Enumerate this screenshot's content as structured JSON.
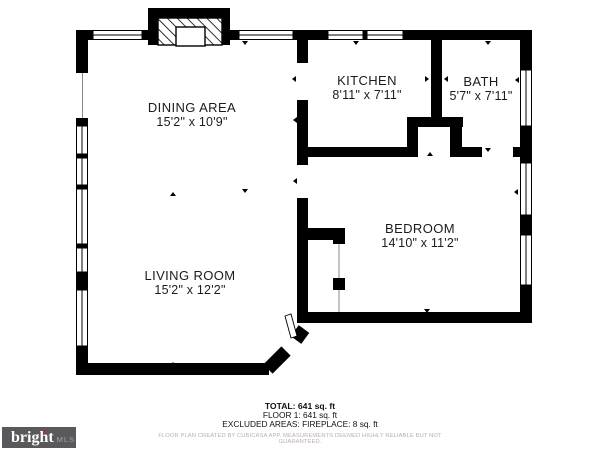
{
  "title": "Floor plan",
  "rooms": [
    {
      "id": "dining",
      "name": "DINING AREA",
      "dims": "15'2\" x 10'9\""
    },
    {
      "id": "kitchen",
      "name": "KITCHEN",
      "dims": "8'11\" x 7'11\""
    },
    {
      "id": "bath",
      "name": "BATH",
      "dims": "5'7\" x 7'11\""
    },
    {
      "id": "living",
      "name": "LIVING ROOM",
      "dims": "15'2\" x 12'2\""
    },
    {
      "id": "bedroom",
      "name": "BEDROOM",
      "dims": "14'10\" x 11'2\""
    }
  ],
  "summary": {
    "total": "TOTAL: 641 sq. ft",
    "floor1": "FLOOR 1: 641 sq. ft",
    "excluded": "EXCLUDED AREAS: FIREPLACE: 8 sq. ft",
    "disclaimer": "FLOOR PLAN CREATED BY CUBICASA APP. MEASUREMENTS DEEMED HIGHLY RELIABLE BUT NOT GUARANTEED."
  },
  "logo": {
    "brand": "bright",
    "trademark": "TM",
    "suffix": "MLS"
  },
  "colors": {
    "wall": "#000000",
    "text": "#1b1b1b",
    "logo_bg": "#59595b",
    "logo_suffix": "#a4a4a6",
    "accent_red": "#cf2030",
    "disclaimer_text": "#b9aeae"
  }
}
